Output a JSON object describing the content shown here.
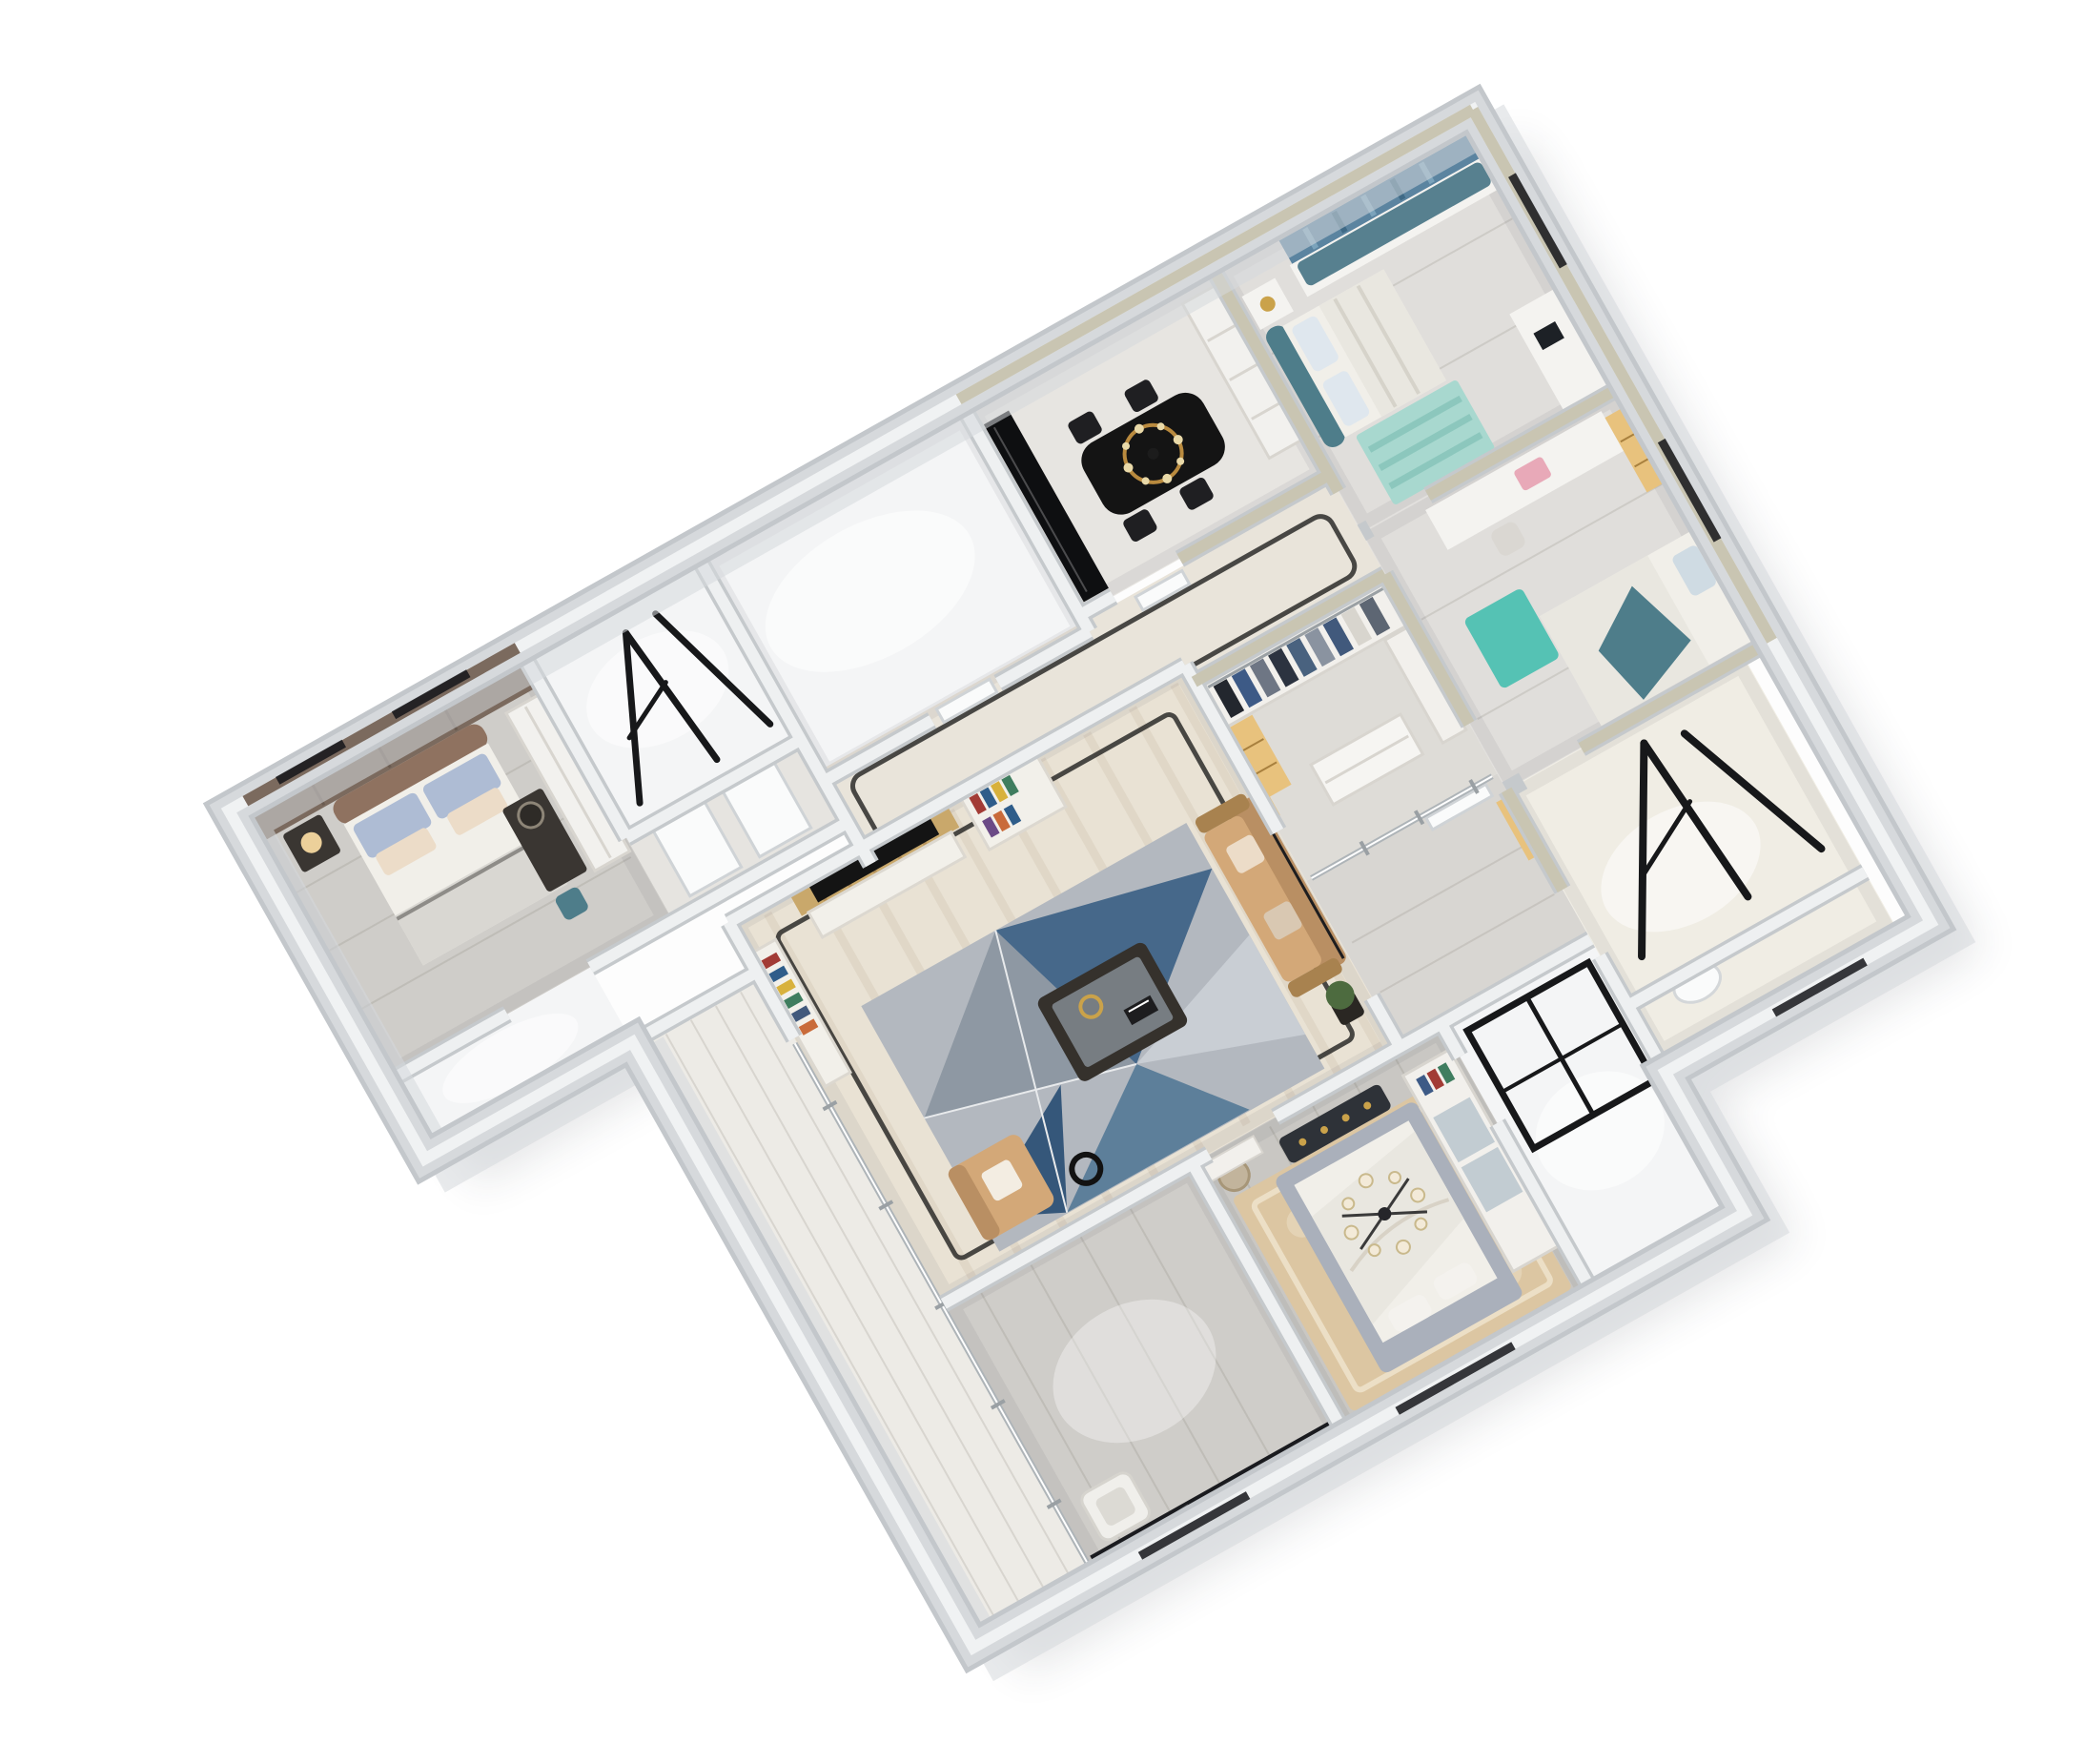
{
  "meta": {
    "title": "Axonometric 3D dollhouse render of a four-bedroom apartment floor plan",
    "view": "top-down isometric cutaway, white background",
    "render_type": "architectural interior visualization"
  },
  "palette": {
    "bg": "#ffffff",
    "shadow": "#2e3440",
    "wall_outer": "#d6d9dc",
    "wall_outer_edge": "#c3c7cb",
    "wall_top": "#f0f2f3",
    "wall_sage": "#c9c5b2",
    "wall_brown": "#7b6a5e",
    "slab": "#fdfdfd",
    "floor_white": "#f4f5f6",
    "floor_gray": "#cfcdc9",
    "floor_wood": "#e0dedb",
    "floor_wood_gray": "#c9c7c3",
    "floor_corridor": "#e9e4da",
    "floor_marble": "#e9e2d4",
    "floor_balcony": "#edebe6",
    "floor_tile": "#f0ede4",
    "rug_base": "#b3b8bf",
    "rug_gray": "#8e98a3",
    "rug_blue": "#46688a",
    "rug_blue_dark": "#35577a",
    "rug_light": "#c9ced4",
    "rug_beige": "#dcc6a2",
    "rug_teal": "#a8d8cf",
    "rug_teal_bright": "#55c2b4",
    "sofa_tan": "#d3a878",
    "sofa_back": "#b98f63",
    "pillow_cream": "#ecdcc8",
    "pillow_blue": "#aebcd4",
    "wood_panel": "#c9a86b",
    "black": "#141414",
    "frame_black": "#17181a",
    "teal": "#4e7d8a",
    "cushion_teal": "#57808f",
    "curtain": "#5b84a0",
    "bed_white": "#f1efe9",
    "duvet": "#e9e7e0",
    "bed_gray": "#aab0bb",
    "headboard_brown": "#8f7260",
    "bench_dark": "#2e3238",
    "gold": "#caa24a",
    "amber": "#e8c27d",
    "lamp_warm": "#f5d9a0",
    "plant": "#4d6b3f",
    "pink": "#e8a9b8",
    "furniture_white": "#f4f3f0",
    "furniture_dark": "#3a3632",
    "glass": "#c2ccd2",
    "railing": "#141519"
  },
  "rooms": [
    {
      "id": "bedroom-west",
      "furniture": [
        "brown-panel-headboard-wall",
        "double-bed",
        "blue-gray-pillows",
        "nightstand",
        "warm-lamp",
        "dark-desk",
        "round-mirror",
        "teal-chair",
        "white-wardrobe"
      ]
    },
    {
      "id": "utility-room",
      "furniture": [
        "black-drying-frames"
      ]
    },
    {
      "id": "kitchen",
      "furniture": []
    },
    {
      "id": "dining-room",
      "furniture": [
        "black-dining-table",
        "dark-chairs",
        "gold-chandelier",
        "white-sideboard",
        "black-glass-partition"
      ]
    },
    {
      "id": "bedroom-east-1",
      "furniture": [
        "teal-headboard-bed",
        "window-seat-teal-cushion",
        "blue-curtains",
        "nightstand",
        "gold-lamp",
        "desk-with-laptop",
        "teal-striped-rug"
      ]
    },
    {
      "id": "bedroom-east-2",
      "furniture": [
        "desk-with-chair",
        "pink-laptop",
        "window-seat",
        "bed-with-teal-throw",
        "teal-rug",
        "lit-shelf-niche"
      ]
    },
    {
      "id": "bathroom-se",
      "furniture": [
        "black-glass-shower-frames"
      ]
    },
    {
      "id": "corridor",
      "furniture": [
        "marble-floor-black-inlay",
        "white-doors",
        "lit-niche-shelves"
      ]
    },
    {
      "id": "walk-in-closet",
      "furniture": [
        "wardrobes",
        "hanging-clothes",
        "drawer-island",
        "glass-doors"
      ]
    },
    {
      "id": "living-room",
      "furniture": [
        "wood-slat-tv-wall",
        "tv",
        "media-cabinet",
        "bookshelves",
        "tan-sofa",
        "tan-armchair",
        "coffee-table",
        "floor-lamp",
        "geometric-rug",
        "plant",
        "black-floor-inlay"
      ]
    },
    {
      "id": "master-bedroom",
      "furniture": [
        "gray-upholstered-bed",
        "white-duvet",
        "patterned-bench",
        "candle-chandelier",
        "glass-door-wardrobe",
        "beige-ornate-rug",
        "stool"
      ]
    },
    {
      "id": "master-bathroom",
      "furniture": [
        "black-glass-shower-frame"
      ]
    },
    {
      "id": "sw-lounge",
      "furniture": [
        "white-armchair",
        "dark-marble-tv-wall"
      ]
    },
    {
      "id": "balcony",
      "furniture": [
        "black-railing-segments",
        "glass-wall"
      ]
    }
  ],
  "counts": {
    "balcony_railing_dashes": 8,
    "hanging_clothes": 9,
    "chandelier_candles": 8
  }
}
